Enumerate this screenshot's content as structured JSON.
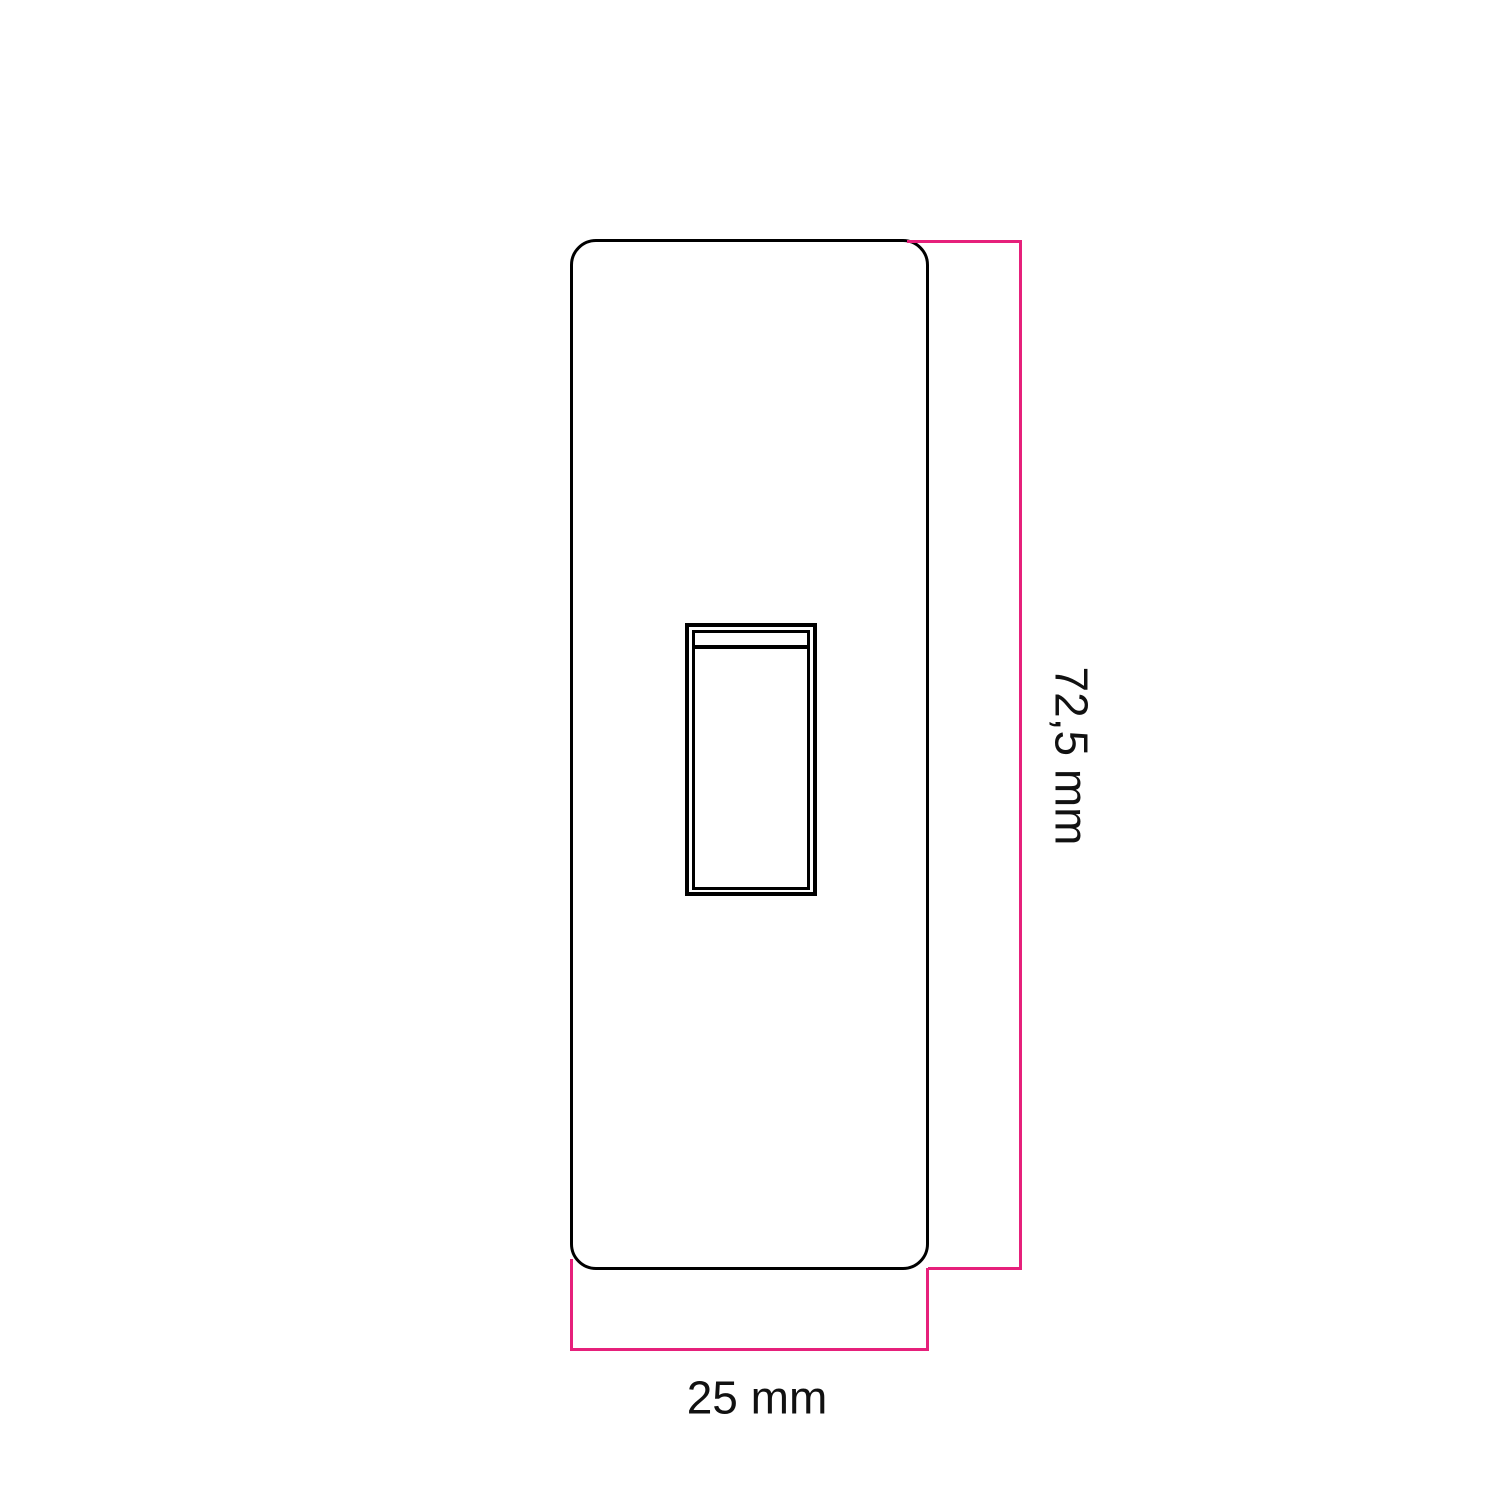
{
  "colors": {
    "background": "#ffffff",
    "outline": "#000000",
    "dimension": "#e6207b",
    "text": "#111111"
  },
  "diagram": {
    "dimensions": {
      "height_label": "72,5 mm",
      "width_label": "25 mm"
    }
  }
}
